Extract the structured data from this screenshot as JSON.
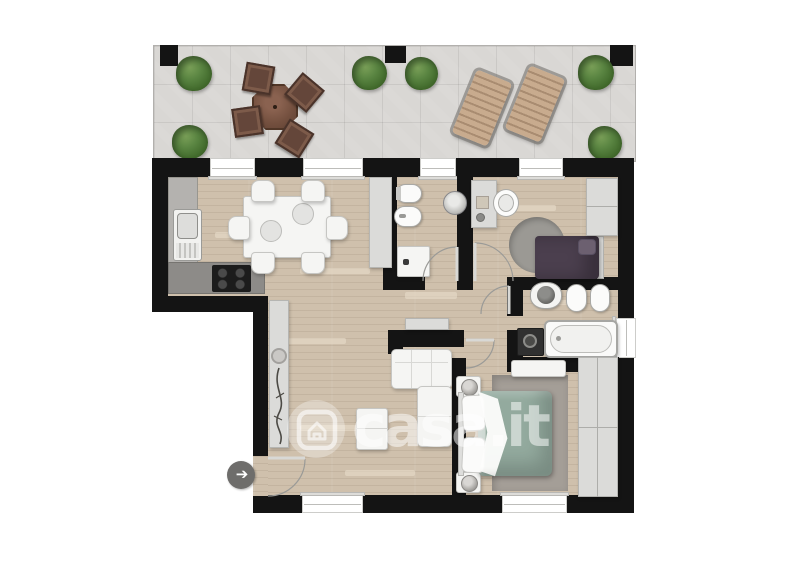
{
  "watermark": {
    "text": "casa.it",
    "logo": "casa-house-logo-icon"
  },
  "plan_type": "apartment floor plan, top-down render, no text labels",
  "palette": {
    "wall": "#141414",
    "wood": "#cfc0ac",
    "tile": "#d9d7d4",
    "plant": "#4d7a38",
    "patio_wood": "#6e4d3e",
    "lounger_wood": "#c2a386",
    "cabinet": "#dbdbd9",
    "counter_dark": "#8d8b88",
    "counter_light": "#b4b2af",
    "cooktop": "#1c1c1c",
    "bed_single": "#4b3f4e",
    "bed_master": "#93aa9e",
    "rug_round": "#92908b",
    "rug_rect": "#a49e97",
    "appliance_dark": "#303030",
    "arrow_circle": "#6e6d6b",
    "watermark": "rgba(255,255,255,0.52)"
  },
  "terrace": {
    "name": "terrace",
    "furniture": [
      "6 plant bushes",
      "octagonal wooden table",
      "4 wooden chairs",
      "2 sun loungers"
    ],
    "pillars": 3
  },
  "rooms": [
    {
      "name": "kitchen-dining",
      "furniture": [
        "L-shaped kitchen counter",
        "sink with drainer",
        "cooktop with 4 burners",
        "tall cabinet",
        "rectangular dining table",
        "6 chairs"
      ]
    },
    {
      "name": "small-bathroom",
      "furniture": [
        "toilet",
        "bidet",
        "round washbasin",
        "washing machine"
      ]
    },
    {
      "name": "single-bedroom",
      "furniture": [
        "desk",
        "desk chair",
        "round rug",
        "single bed with dark duvet",
        "wardrobe"
      ]
    },
    {
      "name": "main-bathroom",
      "furniture": [
        "washbasin with dark bowl",
        "toilet",
        "bidet",
        "washing machine",
        "bathtub"
      ]
    },
    {
      "name": "living-room",
      "furniture": [
        "sideboard with decor plate and branch",
        "corner sofa",
        "coffee table",
        "hall console"
      ]
    },
    {
      "name": "master-bedroom",
      "furniture": [
        "double bed with sage duvet and white pillows",
        "2 nightstands with lamps",
        "dresser",
        "rug",
        "wardrobe"
      ]
    }
  ],
  "openings": {
    "windows_top_wall": 4,
    "windows_bottom_wall": 2,
    "windows_right_wall": 1,
    "entrance_door": 1,
    "interior_doors": 4,
    "entrance_indicator": "gray circle with white right arrow"
  }
}
